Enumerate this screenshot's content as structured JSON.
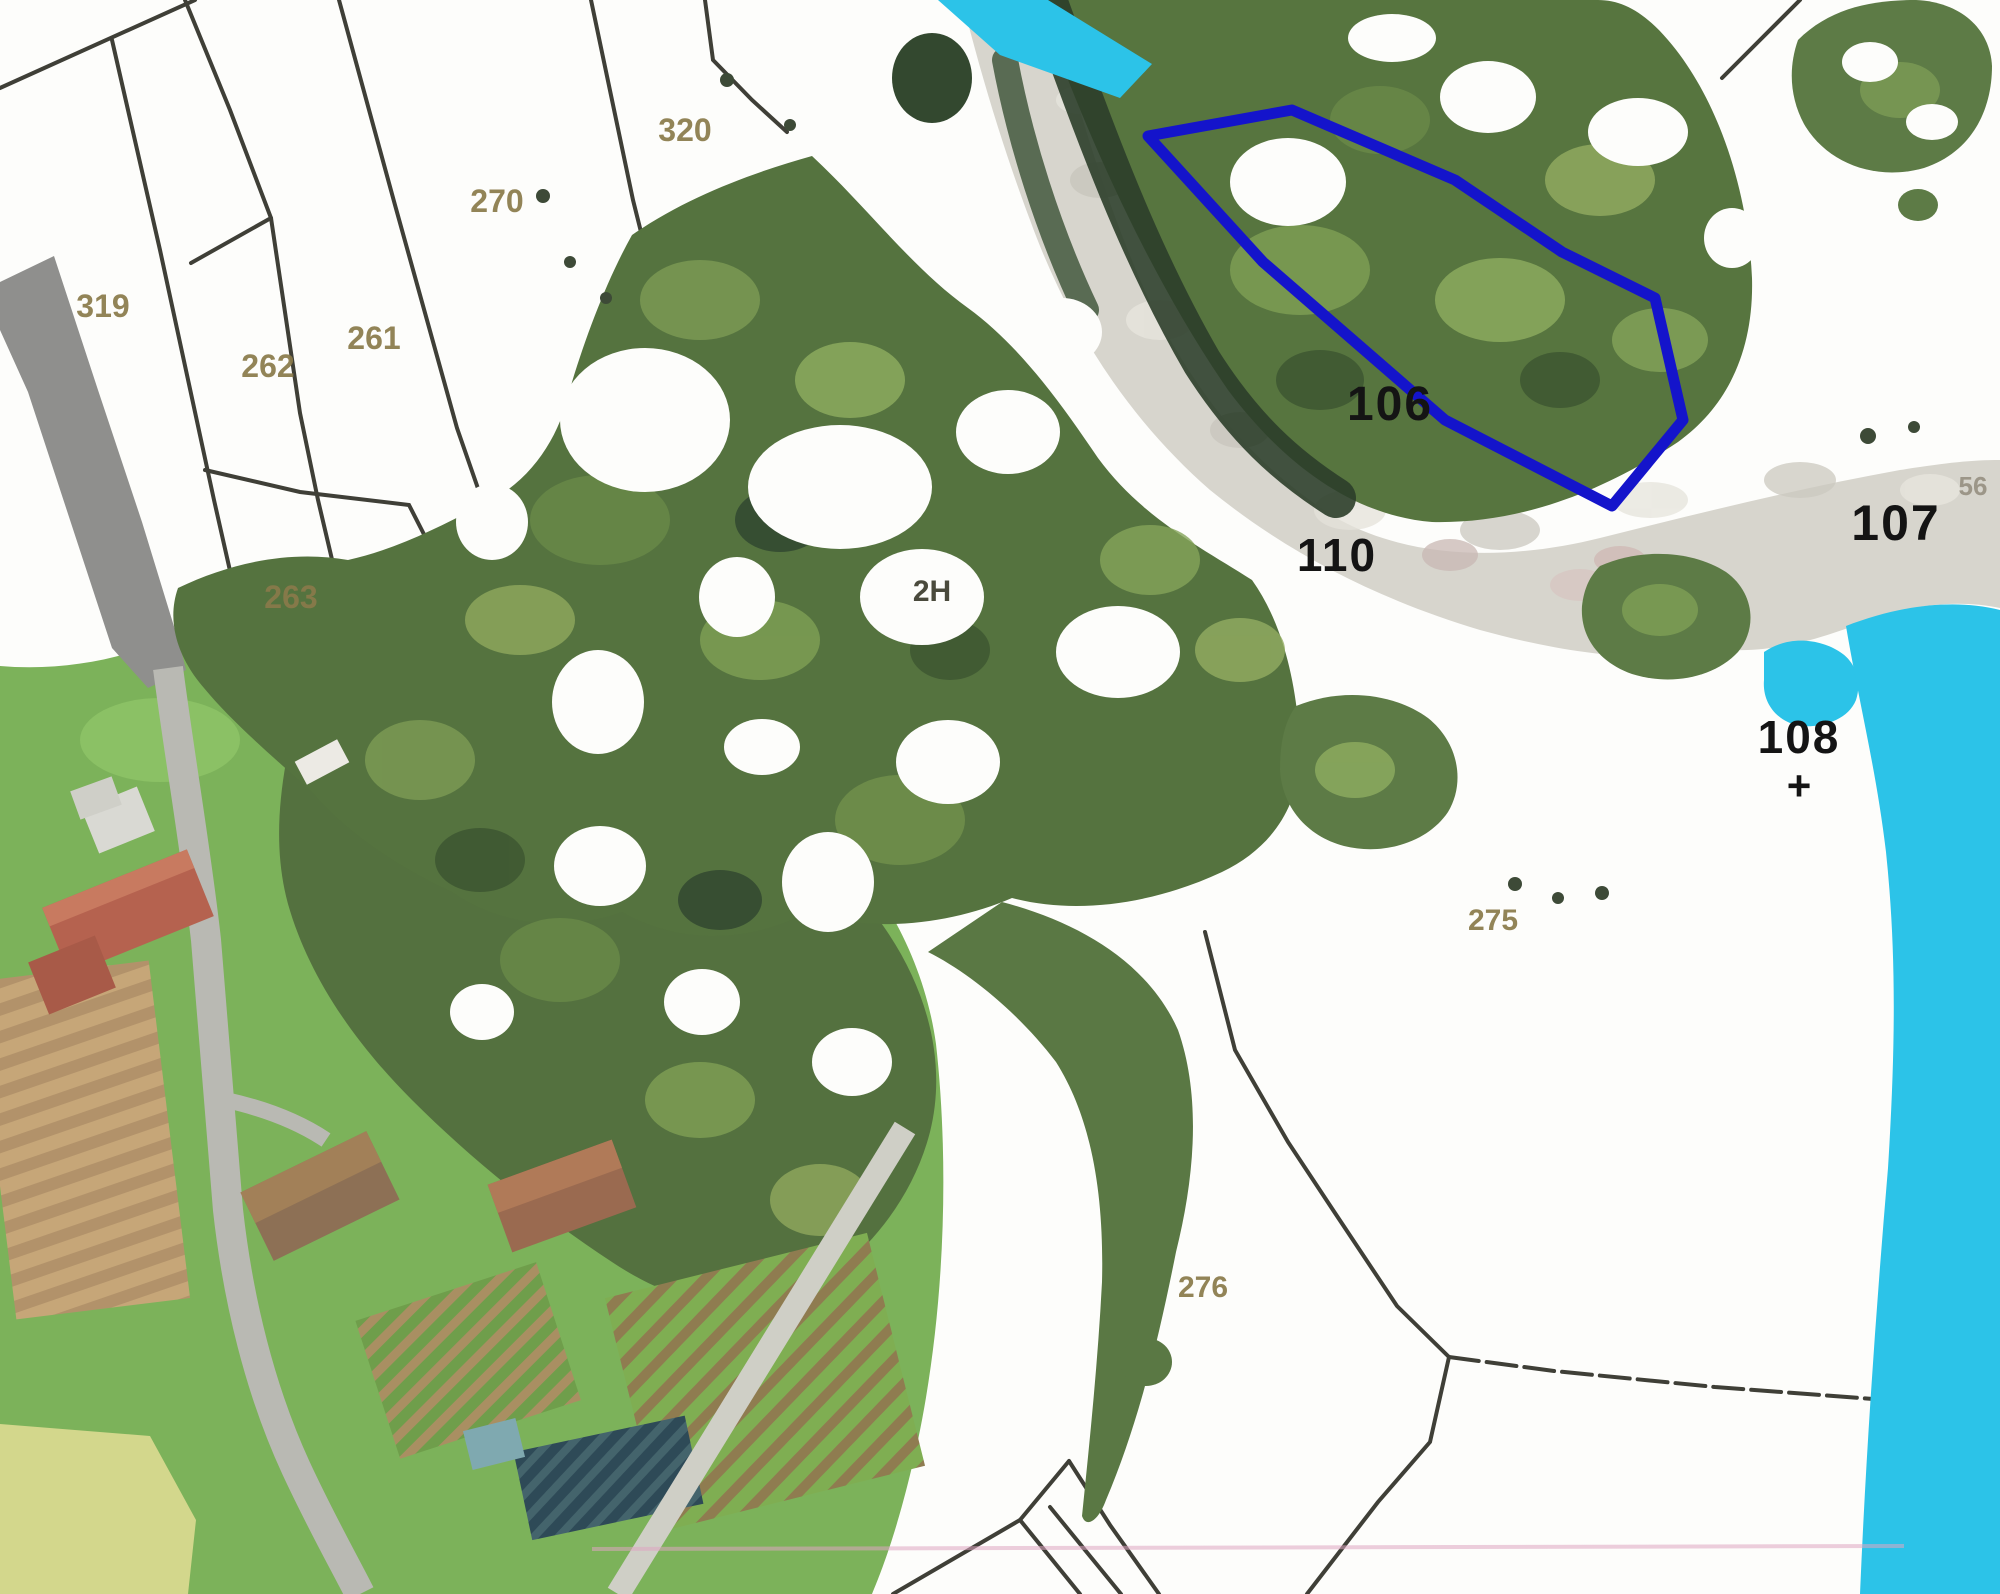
{
  "map": {
    "title": "Cadastral parcel map over orthophoto with river and highlighted parcel",
    "colors": {
      "background": "#fdfdfb",
      "cadastral_line": "#3f3f37",
      "road_band": "#8f8f8d",
      "water": "#2cc3e8",
      "gravel_riverbed": "#d7d5cd",
      "forest": "#54713f",
      "meadow": "#7cb25a",
      "highlight_polygon": "#1414cb",
      "survey_label": "#141414",
      "cadastral_label": "#8a7a4a",
      "pink_reference_line": "#dfa6c2"
    },
    "parcel_labels": [
      {
        "text": "320",
        "x": 685,
        "y": 141,
        "size": 32,
        "style": "cadastral"
      },
      {
        "text": "270",
        "x": 497,
        "y": 212,
        "size": 32,
        "style": "cadastral"
      },
      {
        "text": "319",
        "x": 103,
        "y": 317,
        "size": 32,
        "style": "cadastral"
      },
      {
        "text": "261",
        "x": 374,
        "y": 349,
        "size": 32,
        "style": "cadastral"
      },
      {
        "text": "262",
        "x": 268,
        "y": 377,
        "size": 32,
        "style": "cadastral"
      },
      {
        "text": "263",
        "x": 291,
        "y": 608,
        "size": 32,
        "style": "cadastral"
      },
      {
        "text": "275",
        "x": 1493,
        "y": 930,
        "size": 30,
        "style": "cadastral"
      },
      {
        "text": "276",
        "x": 1203,
        "y": 1297,
        "size": 30,
        "style": "cadastral"
      },
      {
        "text": "56",
        "x": 1973,
        "y": 495,
        "size": 26,
        "style": "cadastral-light"
      },
      {
        "text": "2H",
        "x": 932,
        "y": 601,
        "size": 30,
        "style": "cadastral-dark"
      },
      {
        "text": "106",
        "x": 1390,
        "y": 420,
        "size": 48,
        "style": "survey"
      },
      {
        "text": "110",
        "x": 1337,
        "y": 571,
        "size": 46,
        "style": "survey"
      },
      {
        "text": "107",
        "x": 1896,
        "y": 540,
        "size": 50,
        "style": "survey"
      },
      {
        "text": "108",
        "x": 1799,
        "y": 753,
        "size": 46,
        "style": "survey"
      }
    ],
    "symbols": [
      {
        "type": "plus-mark",
        "text": "+",
        "x": 1799,
        "y": 800,
        "size": 42
      }
    ],
    "highlight_parcel": {
      "label": "106",
      "color": "#1414cb",
      "stroke_width": 11,
      "points": "1148,136 1292,110 1455,180 1562,252 1655,298 1683,420 1612,506 1445,420 1263,262"
    }
  }
}
